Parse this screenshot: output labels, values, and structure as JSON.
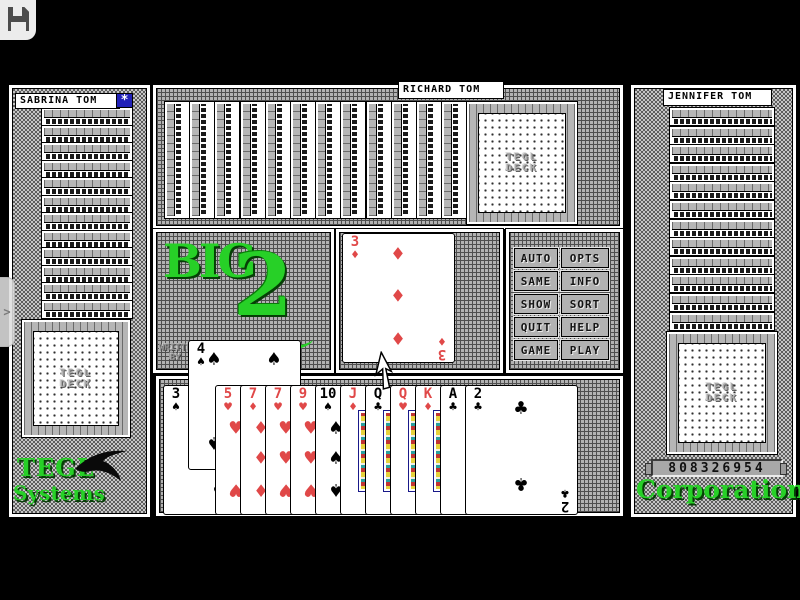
{
  "titlebar": {
    "icon": "floppy-disk"
  },
  "edge_tab": {
    "icon": "chevron-right",
    "glyph": ">"
  },
  "icons": {
    "turn_badge": "*"
  },
  "players": {
    "left": {
      "name": "SABRINA TOM",
      "face_down_cards": 13,
      "badge_icon": "starburst"
    },
    "top": {
      "name": "RICHARD TOM",
      "face_down_cards": 13
    },
    "right": {
      "name": "JENNIFER TOM",
      "face_down_cards": 13
    },
    "bottom": {
      "hand": [
        {
          "rank": "3",
          "suit": "spades"
        },
        {
          "rank": "5",
          "suit": "hearts"
        },
        {
          "rank": "7",
          "suit": "diamonds"
        },
        {
          "rank": "7",
          "suit": "hearts"
        },
        {
          "rank": "9",
          "suit": "hearts"
        },
        {
          "rank": "10",
          "suit": "spades"
        },
        {
          "rank": "J",
          "suit": "diamonds"
        },
        {
          "rank": "Q",
          "suit": "clubs"
        },
        {
          "rank": "Q",
          "suit": "hearts"
        },
        {
          "rank": "K",
          "suit": "diamonds"
        },
        {
          "rank": "A",
          "suit": "clubs"
        },
        {
          "rank": "2",
          "suit": "clubs"
        }
      ]
    }
  },
  "table": {
    "current_play": {
      "rank": "3",
      "suit": "diamonds"
    },
    "bottom_last_play": {
      "rank": "4",
      "suit": "spades"
    }
  },
  "logo": {
    "word": "BIG",
    "numeral": "2",
    "credits": "WRITTEN BY"
  },
  "deck_back_label": "TEGL DECK",
  "action_buttons": [
    [
      "AUTO",
      "OPTS"
    ],
    [
      "SAME",
      "INFO"
    ],
    [
      "SHOW",
      "SORT"
    ],
    [
      "QUIT",
      "HELP"
    ],
    [
      "GAME",
      "PLAY"
    ]
  ],
  "branding": {
    "company_top": "TEGL",
    "company_bottom": "Systems",
    "company_right": "Corporation",
    "serial_number": "808326954",
    "logo_icon": "bird-silhouette"
  },
  "colors": {
    "accent_green": "#27d027",
    "suit_red": "#e04848",
    "badge_blue": "#2121b8",
    "table_grey": "#b2b2b2"
  }
}
